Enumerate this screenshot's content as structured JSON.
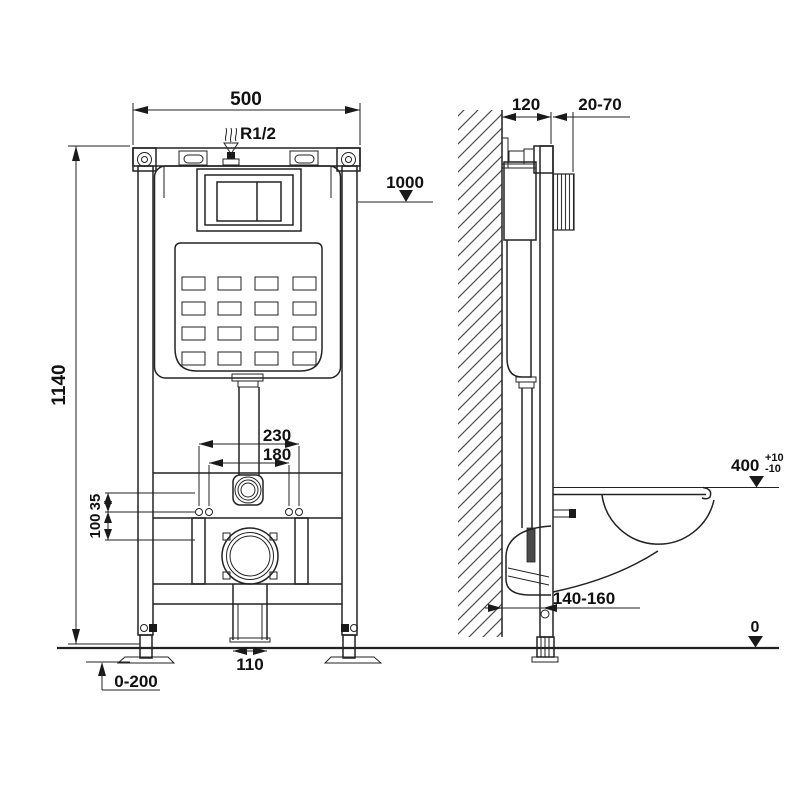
{
  "drawing": {
    "type": "technical-installation-diagram",
    "subject": "concealed-cistern-wall-frame-with-wall-hung-toilet",
    "colors": {
      "line": "#222222",
      "background": "#ffffff",
      "text": "#111111"
    },
    "labels": {
      "front_width": "500",
      "supply_thread": "R1/2",
      "level_1000": "1000",
      "total_height": "1140",
      "bolt_span_outer": "230",
      "bolt_span_inner": "180",
      "offset_35": "35",
      "offset_100": "100",
      "drain_pipe_width": "110",
      "foot_adjust_range": "0-200",
      "frame_depth": "120",
      "plate_depth_range": "20-70",
      "seat_height": "400",
      "seat_tol_plus": "+10",
      "seat_tol_minus": "-10",
      "drain_wall_distance": "140-160",
      "floor_level": "0"
    }
  }
}
